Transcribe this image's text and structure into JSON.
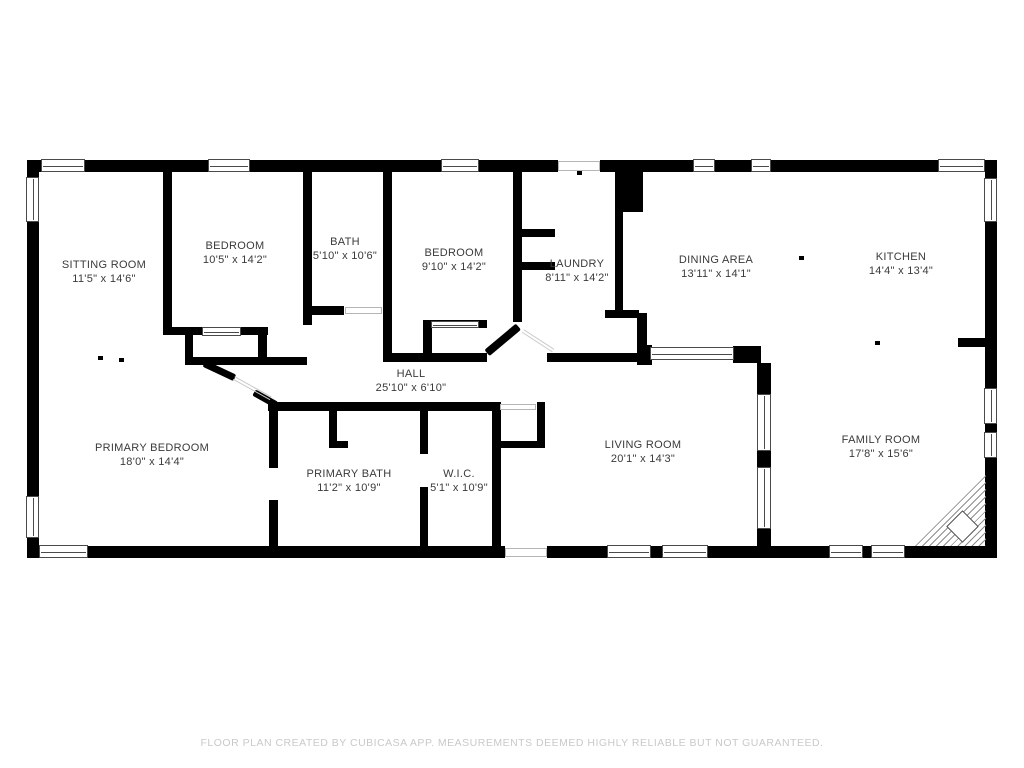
{
  "background": "#ffffff",
  "wall_color": "#000000",
  "label_color": "#3a3a3a",
  "rooms": [
    {
      "name": "SITTING ROOM",
      "dims": "11'5\" x 14'6\""
    },
    {
      "name": "BEDROOM",
      "dims": "10'5\" x 14'2\""
    },
    {
      "name": "BATH",
      "dims": "5'10\" x 10'6\""
    },
    {
      "name": "BEDROOM",
      "dims": "9'10\" x 14'2\""
    },
    {
      "name": "LAUNDRY",
      "dims": "8'11\" x 14'2\""
    },
    {
      "name": "DINING AREA",
      "dims": "13'11\" x 14'1\""
    },
    {
      "name": "KITCHEN",
      "dims": "14'4\" x 13'4\""
    },
    {
      "name": "HALL",
      "dims": "25'10\" x 6'10\""
    },
    {
      "name": "PRIMARY BEDROOM",
      "dims": "18'0\" x 14'4\""
    },
    {
      "name": "PRIMARY BATH",
      "dims": "11'2\" x 10'9\""
    },
    {
      "name": "W.I.C.",
      "dims": "5'1\" x 10'9\""
    },
    {
      "name": "LIVING ROOM",
      "dims": "20'1\" x 14'3\""
    },
    {
      "name": "FAMILY ROOM",
      "dims": "17'8\" x 15'6\""
    }
  ],
  "footer": {
    "disclaimer": "FLOOR PLAN CREATED BY CUBICASA APP. MEASUREMENTS DEEMED HIGHLY RELIABLE BUT NOT GUARANTEED."
  }
}
